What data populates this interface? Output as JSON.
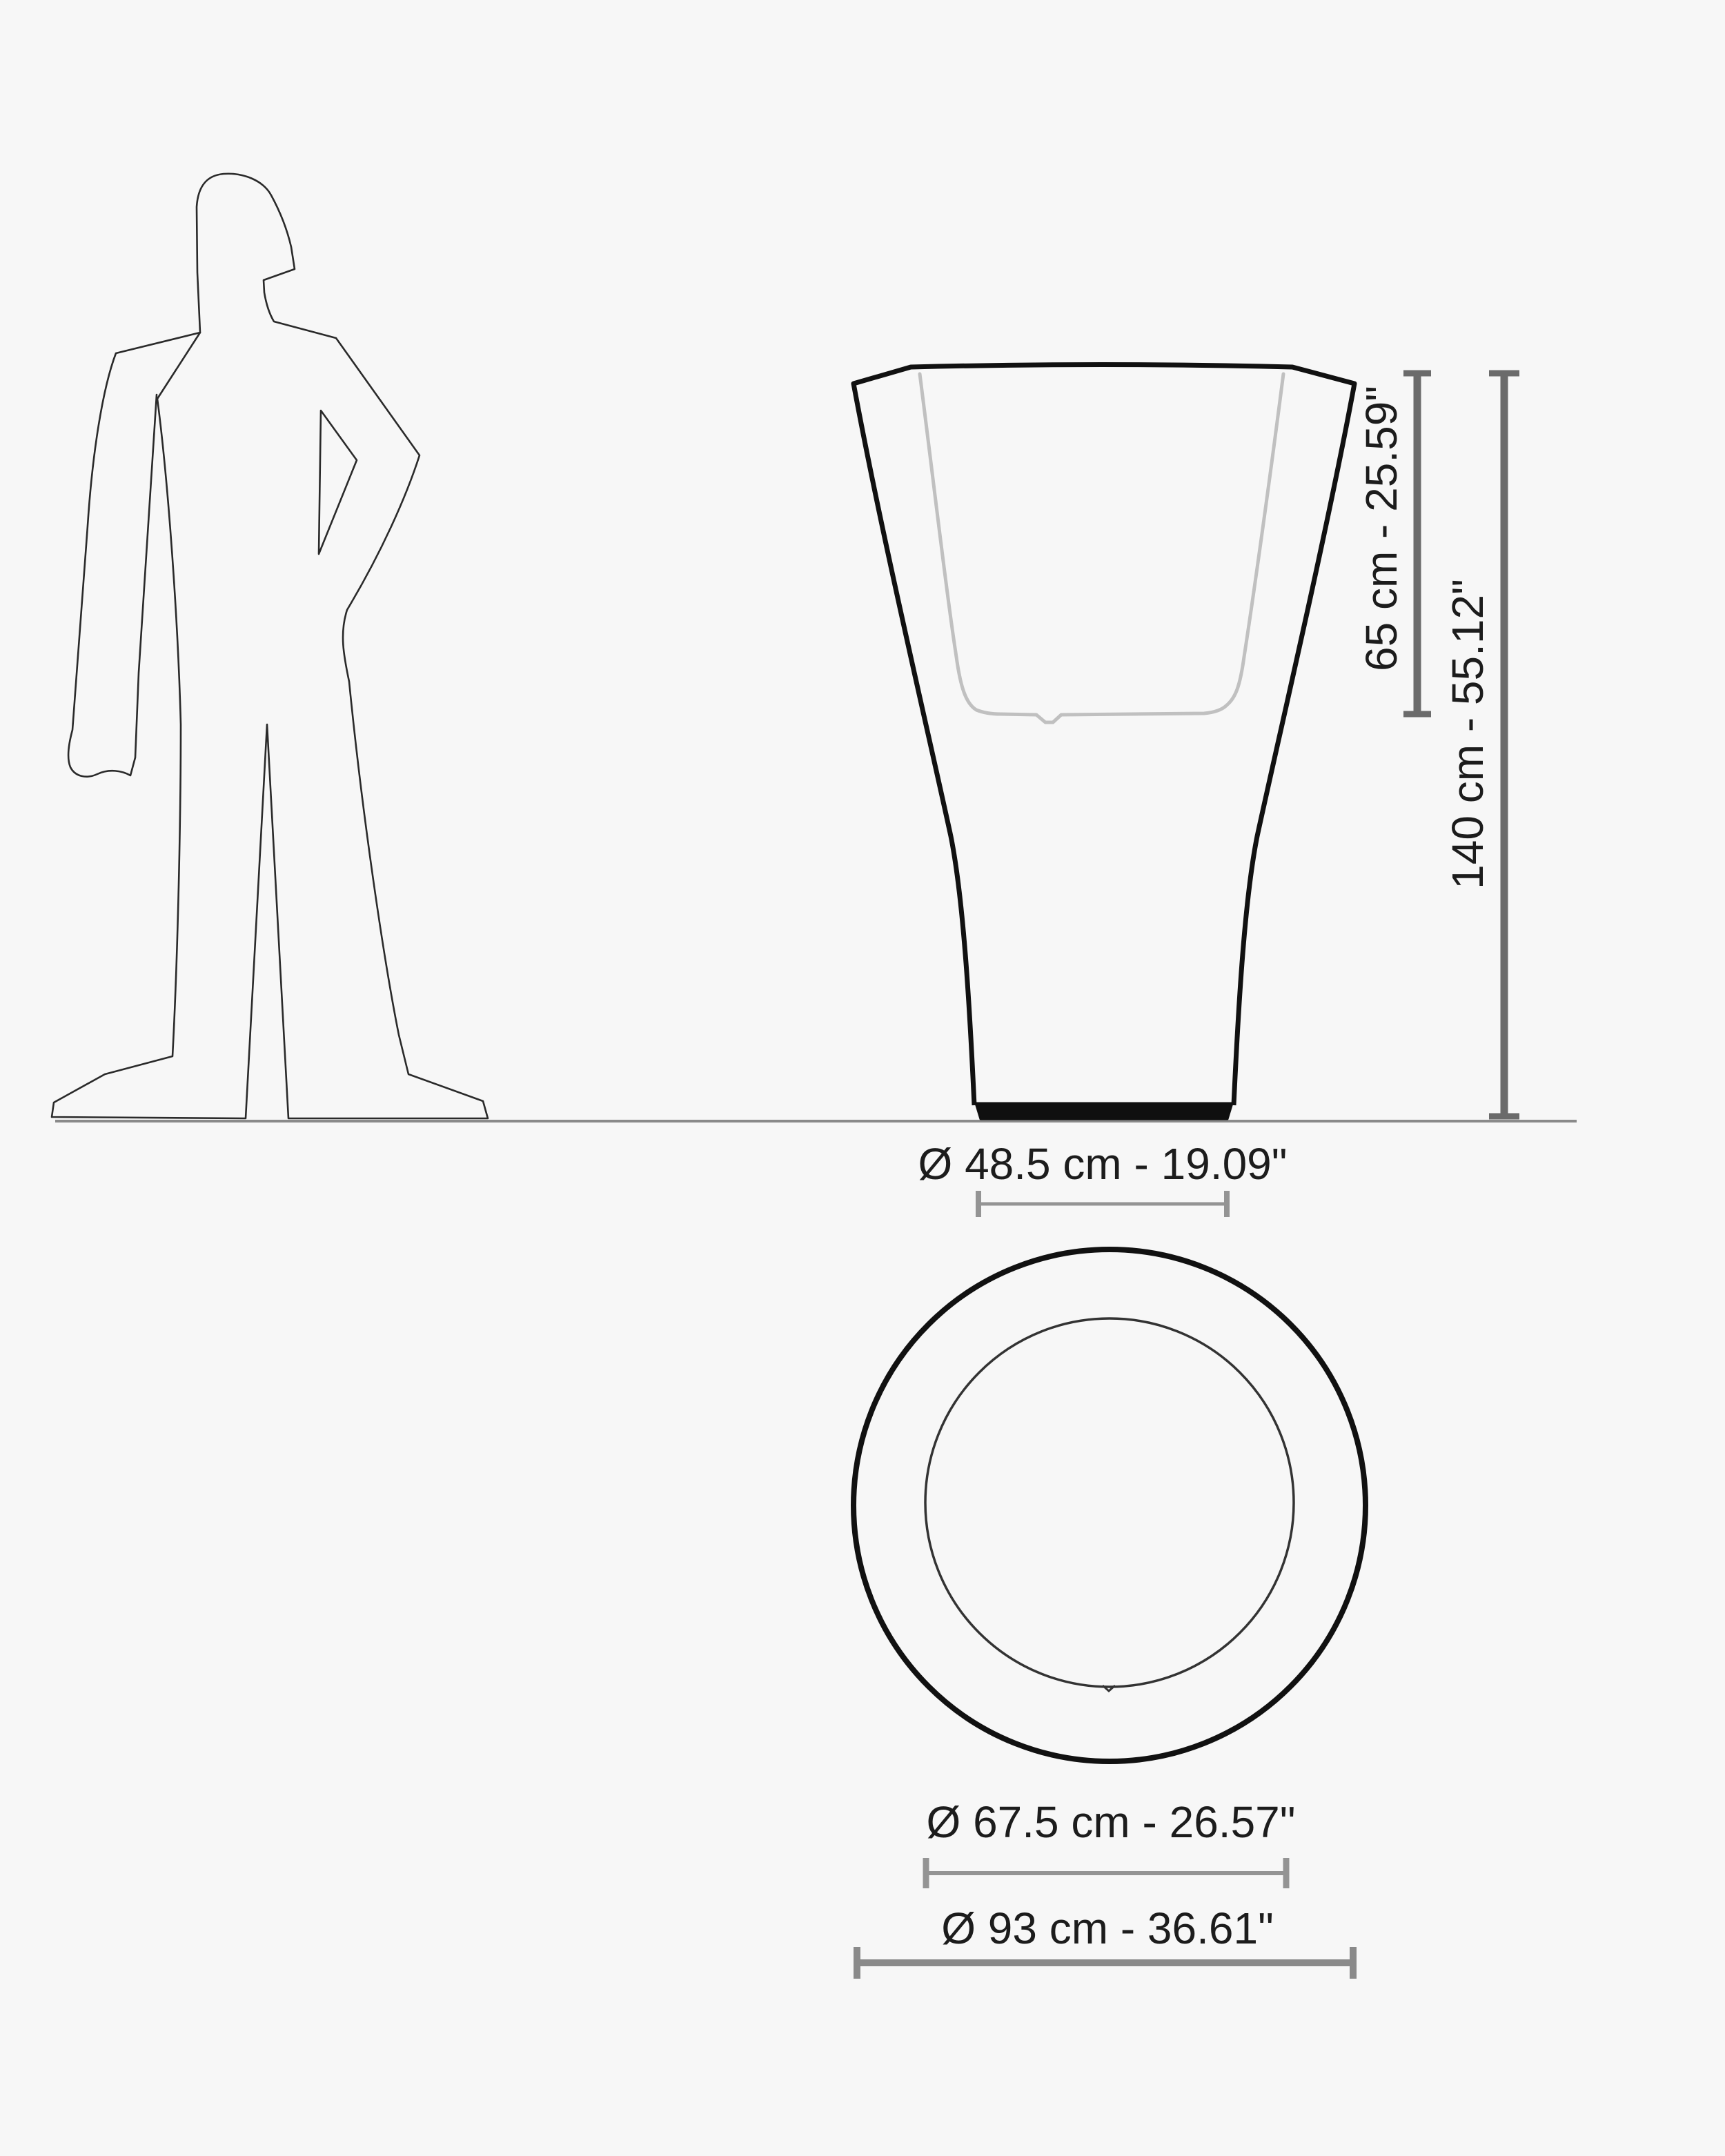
{
  "diagram": {
    "title": "planter-dimension-drawing",
    "labels": {
      "inner_height": "65 cm - 25.59\"",
      "total_height": "140 cm - 55.12\"",
      "base_diameter": "Ø 48.5 cm - 19.09\"",
      "inner_diameter": "Ø 67.5 cm - 26.57\"",
      "outer_diameter": "Ø 93 cm - 36.61\""
    },
    "views": {
      "side_view": "front elevation of flared planter with inner liner",
      "top_view": "plan view with outer and inner circles",
      "scale_reference": "standing human silhouette"
    },
    "colors": {
      "background": "#f7f7f7",
      "vase_outline": "#111111",
      "inner_liner": "#c0c0c0",
      "dimension_bars": "#6b6b6b",
      "dimension_lines": "#8a8a8a",
      "ground_line": "#8a8a8a",
      "text": "#1c1c1c",
      "silhouette_line": "#2a2a2a"
    }
  }
}
